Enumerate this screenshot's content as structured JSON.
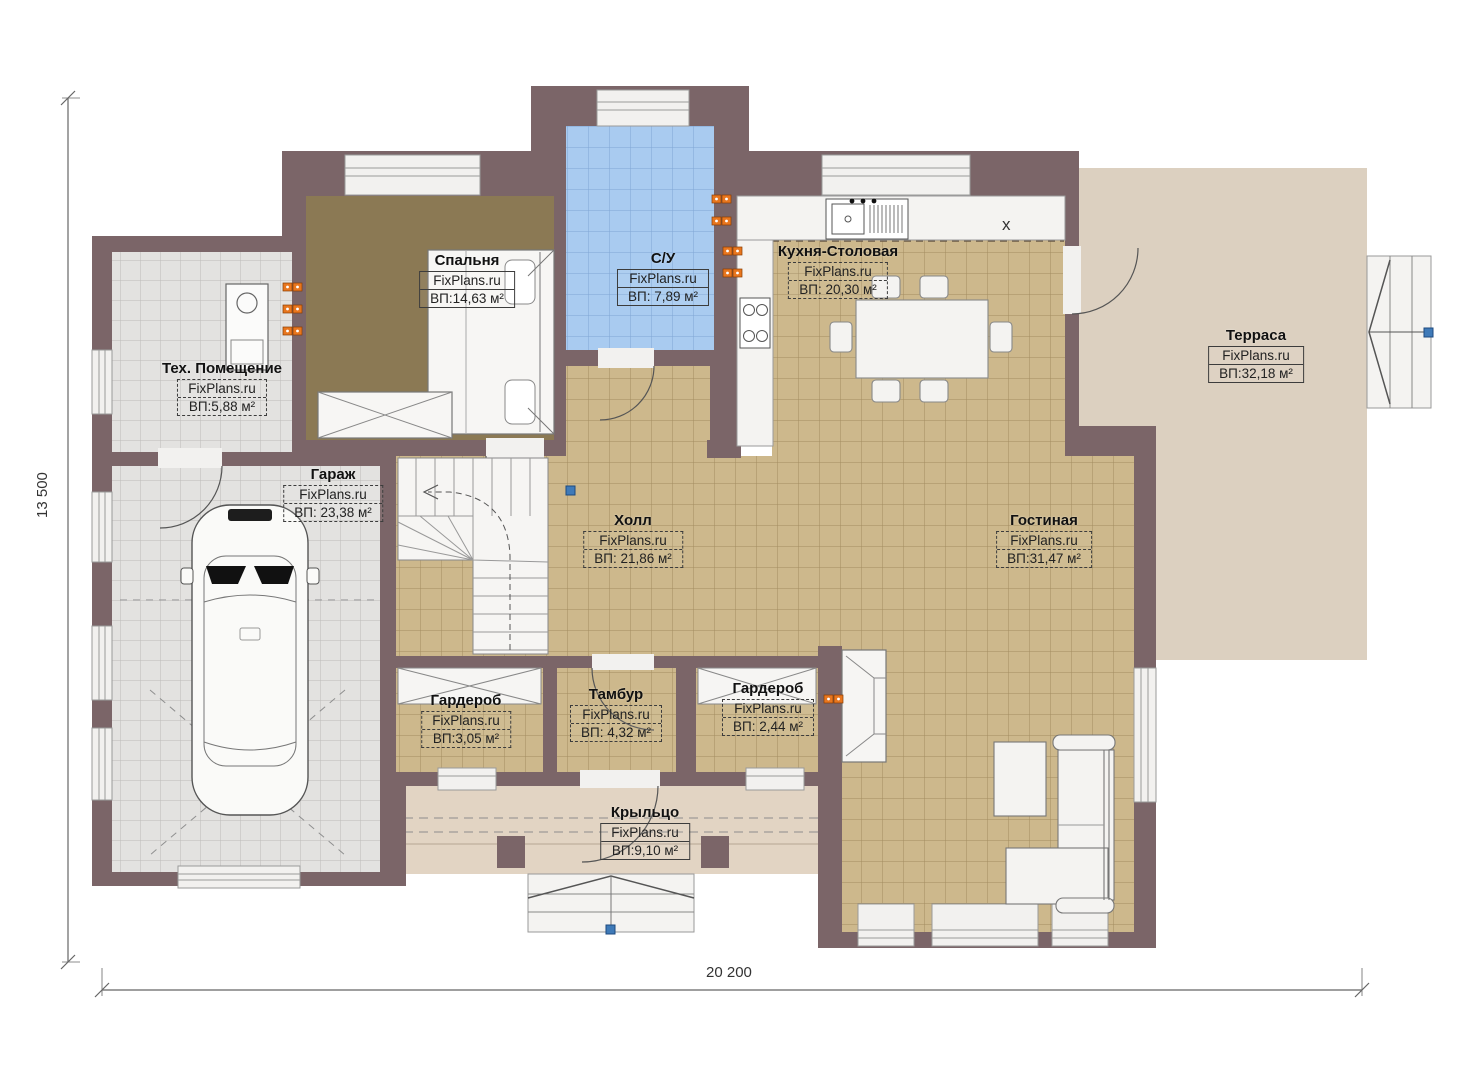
{
  "dimensions": {
    "height_label": "13 500",
    "width_label": "20 200"
  },
  "marks": {
    "hob_x": "x"
  },
  "rooms": [
    {
      "name": "Спальня",
      "brand": "FixPlans.ru",
      "area": "ВП:14,63 м²"
    },
    {
      "name": "С/У",
      "brand": "FixPlans.ru",
      "area": "ВП: 7,89 м²"
    },
    {
      "name": "Кухня-Столовая",
      "brand": "FixPlans.ru",
      "area": "ВП: 20,30 м²"
    },
    {
      "name": "Терраса",
      "brand": "FixPlans.ru",
      "area": "ВП:32,18 м²"
    },
    {
      "name": "Тех. Помещение",
      "brand": "FixPlans.ru",
      "area": "ВП:5,88 м²"
    },
    {
      "name": "Гараж",
      "brand": "FixPlans.ru",
      "area": "ВП: 23,38 м²"
    },
    {
      "name": "Холл",
      "brand": "FixPlans.ru",
      "area": "ВП: 21,86 м²"
    },
    {
      "name": "Гостиная",
      "brand": "FixPlans.ru",
      "area": "ВП:31,47 м²"
    },
    {
      "name": "Гардероб",
      "brand": "FixPlans.ru",
      "area": "ВП:3,05 м²"
    },
    {
      "name": "Тамбур",
      "brand": "FixPlans.ru",
      "area": "ВП: 4,32 м²"
    },
    {
      "name": "Гардероб",
      "brand": "FixPlans.ru",
      "area": "ВП: 2,44 м²"
    },
    {
      "name": "Крыльцо",
      "brand": "FixPlans.ru",
      "area": "ВП:9,10 м²"
    }
  ],
  "colors": {
    "wall": "#7b6568",
    "tile_tan": "#cdb88c",
    "tile_blue": "#a9cbf0",
    "tile_gray": "#e3e2e0",
    "wood_brown": "#8b7954",
    "terrace": "#dcd0c0",
    "porch": "#e2d4c3",
    "socket_orange": "#e8761e",
    "marker_blue": "#3f7ab8"
  }
}
